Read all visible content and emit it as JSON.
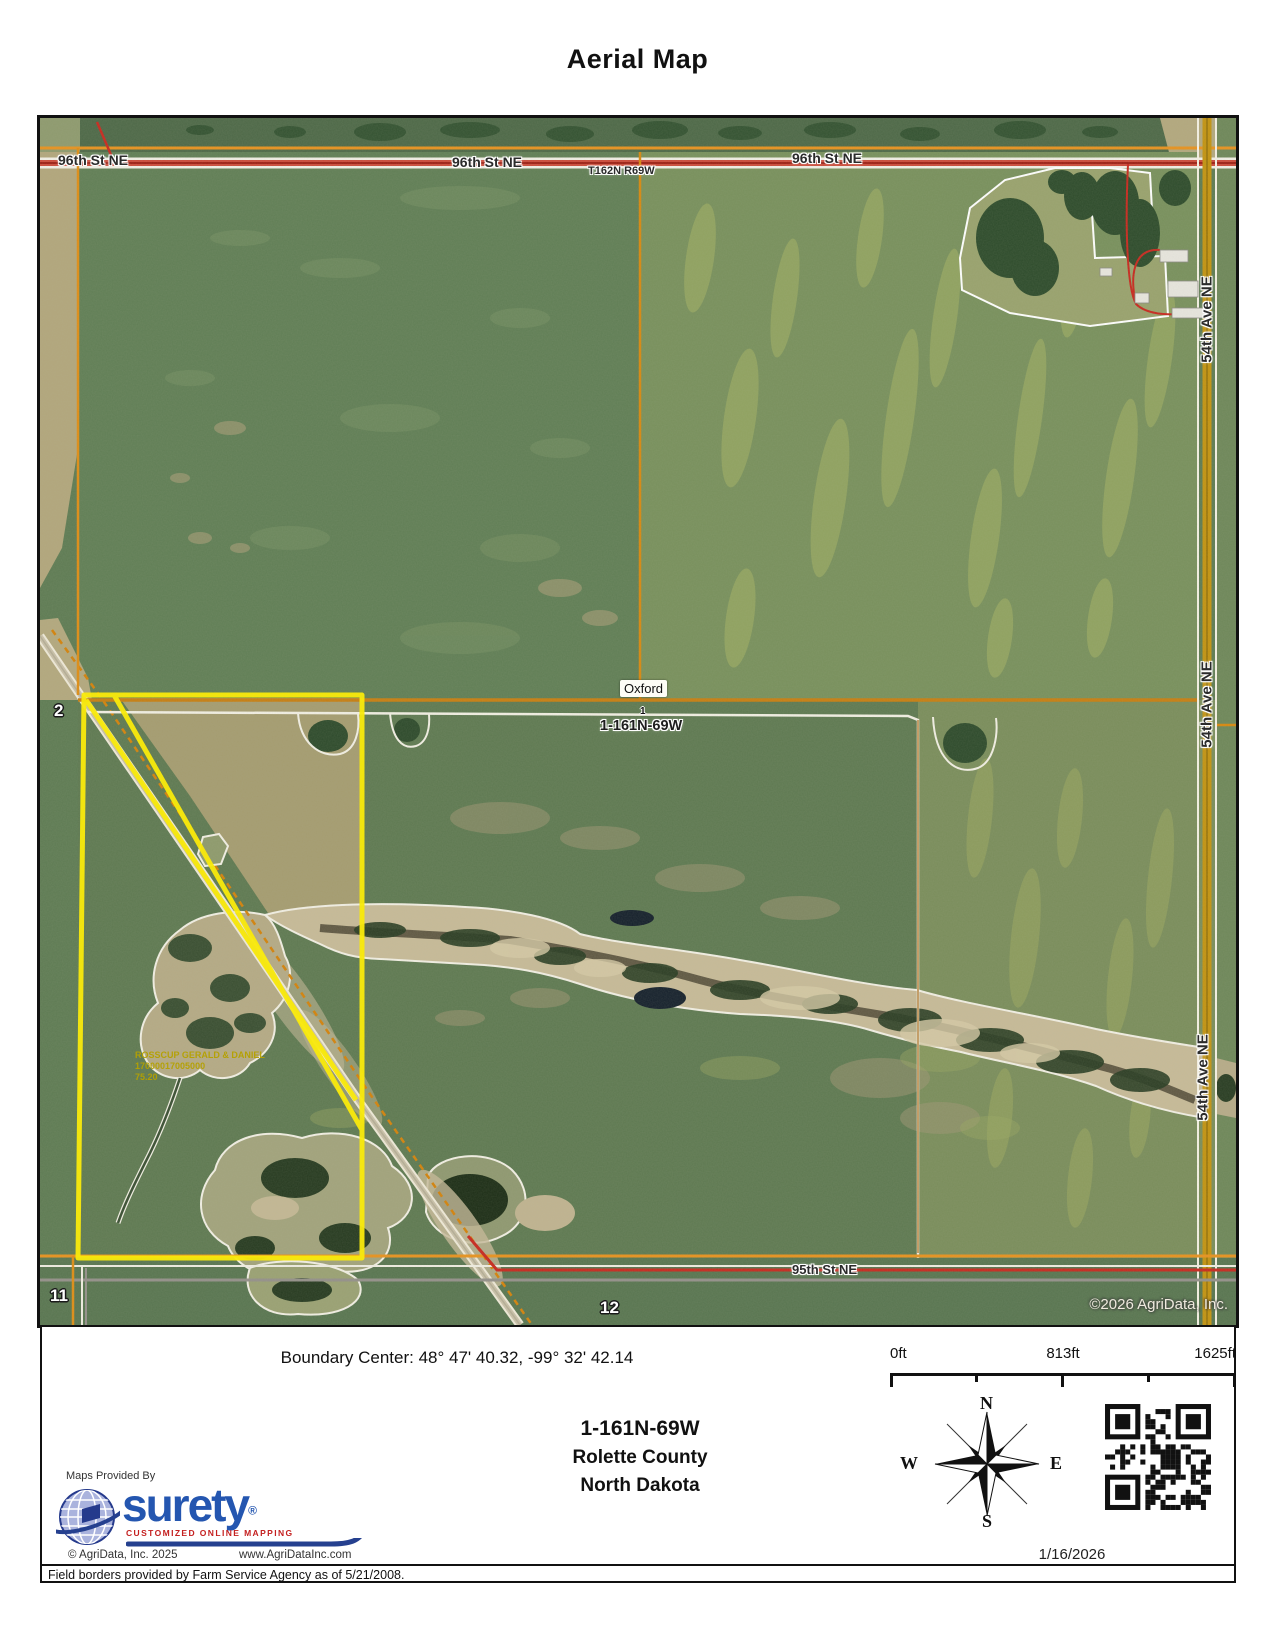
{
  "title": "Aerial Map",
  "map": {
    "street_top_labels": [
      "96th St NE",
      "96th St NE",
      "96th St NE"
    ],
    "township_range_label": "T162N R69W",
    "avenue_labels": [
      "54th Ave NE",
      "54th Ave NE",
      "54th Ave NE"
    ],
    "place_label": "Oxford",
    "township_section_label": "1-161N-69W",
    "street_bottom_label": "95th St NE",
    "section_numbers": {
      "sec1": "1",
      "sec2": "2",
      "sec11": "11",
      "sec12": "12"
    },
    "parcel": {
      "owner": "ROSSCUP GERALD & DANIEL",
      "parcel_number": "17000017005000",
      "acres": "75.20"
    },
    "copyright": "©2026 AgriData, Inc."
  },
  "footer": {
    "boundary_center": "Boundary Center: 48° 47' 40.32,  -99° 32' 42.14",
    "location": {
      "plss": "1-161N-69W",
      "county": "Rolette County",
      "state": "North Dakota"
    },
    "scale": {
      "start": "0ft",
      "middle": "813ft",
      "end": "1625ft"
    },
    "compass": {
      "north": "N",
      "south": "S",
      "east": "E",
      "west": "W"
    },
    "provider_intro": "Maps Provided By",
    "logo": {
      "brand": "surety",
      "registered": "®",
      "tagline": "CUSTOMIZED ONLINE MAPPING"
    },
    "copyright": "© AgriData, Inc. 2025",
    "website": "www.AgriDataInc.com",
    "date": "1/16/2026",
    "disclaimer": "Field borders provided by Farm Service Agency as of 5/21/2008."
  },
  "colors": {
    "highlight_yellow": "#ffee00",
    "section_line_orange": "#e8921e",
    "road_red": "#c8281e",
    "road_gold": "#c39310",
    "brand_blue": "#2456b0",
    "tagline_red": "#c41f1f"
  }
}
